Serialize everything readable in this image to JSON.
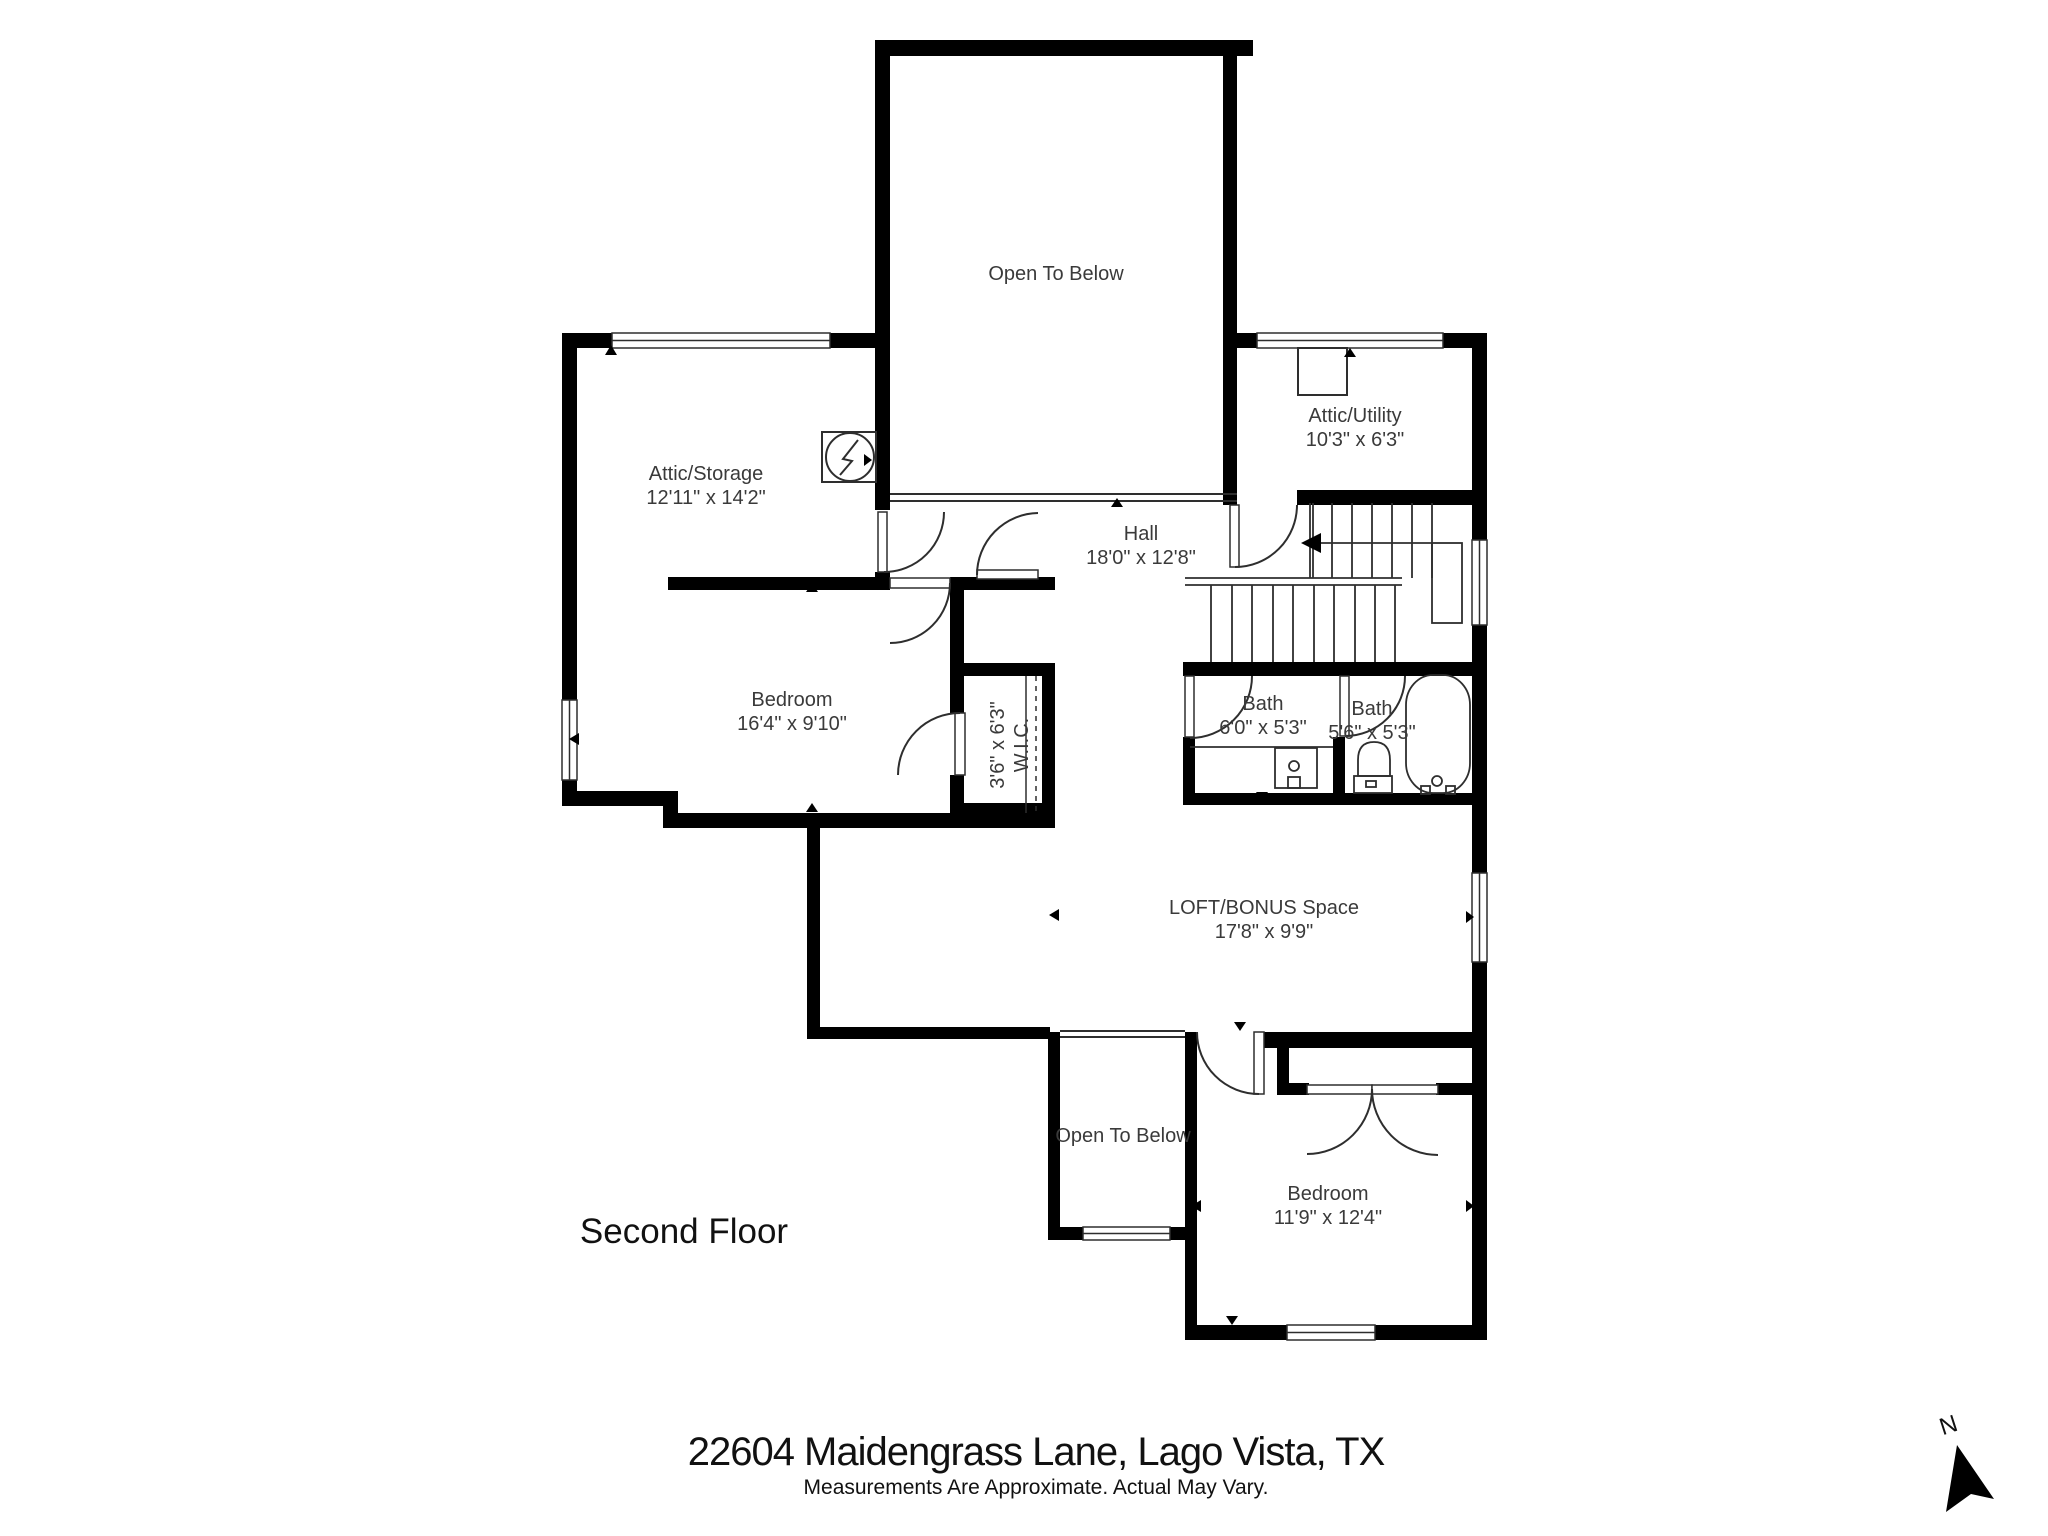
{
  "title": {
    "floor_label": "Second Floor"
  },
  "footer": {
    "address": "22604 Maidengrass Lane, Lago Vista, TX",
    "disclaimer": "Measurements Are Approximate. Actual May Vary."
  },
  "compass": {
    "letter": "N"
  },
  "rooms": [
    {
      "id": "open-to-below-top",
      "name": "Open To Below",
      "dims": ""
    },
    {
      "id": "attic-storage",
      "name": "Attic/Storage",
      "dims": "12'11\" x 14'2\""
    },
    {
      "id": "attic-utility",
      "name": "Attic/Utility",
      "dims": "10'3\" x 6'3\""
    },
    {
      "id": "hall",
      "name": "Hall",
      "dims": "18'0\" x 12'8\""
    },
    {
      "id": "bedroom-left",
      "name": "Bedroom",
      "dims": "16'4\" x 9'10\""
    },
    {
      "id": "wic",
      "name": "W.I.C.",
      "dims": "3'6\" x 6'3\""
    },
    {
      "id": "bath-1",
      "name": "Bath",
      "dims": "6'0\" x 5'3\""
    },
    {
      "id": "bath-2",
      "name": "Bath",
      "dims": "5'6\" x 5'3\""
    },
    {
      "id": "loft-bonus",
      "name": "LOFT/BONUS Space",
      "dims": "17'8\" x 9'9\""
    },
    {
      "id": "open-to-below-bottom",
      "name": "Open To Below",
      "dims": ""
    },
    {
      "id": "bedroom-bottom",
      "name": "Bedroom",
      "dims": "11'9\" x 12'4\""
    }
  ],
  "icons": {
    "electrical_panel": "circle-lightning-bolt",
    "utility_unit": "square-unit",
    "vanity_sink": "counter-with-sink",
    "toilet": "toilet",
    "bathtub": "tub",
    "stairs": "stairs-with-direction-arrow",
    "compass": "north-arrow"
  },
  "colors": {
    "wall": "#000000",
    "line": "#2e2e2e",
    "label": "#3a3a3a",
    "background": "#ffffff"
  }
}
